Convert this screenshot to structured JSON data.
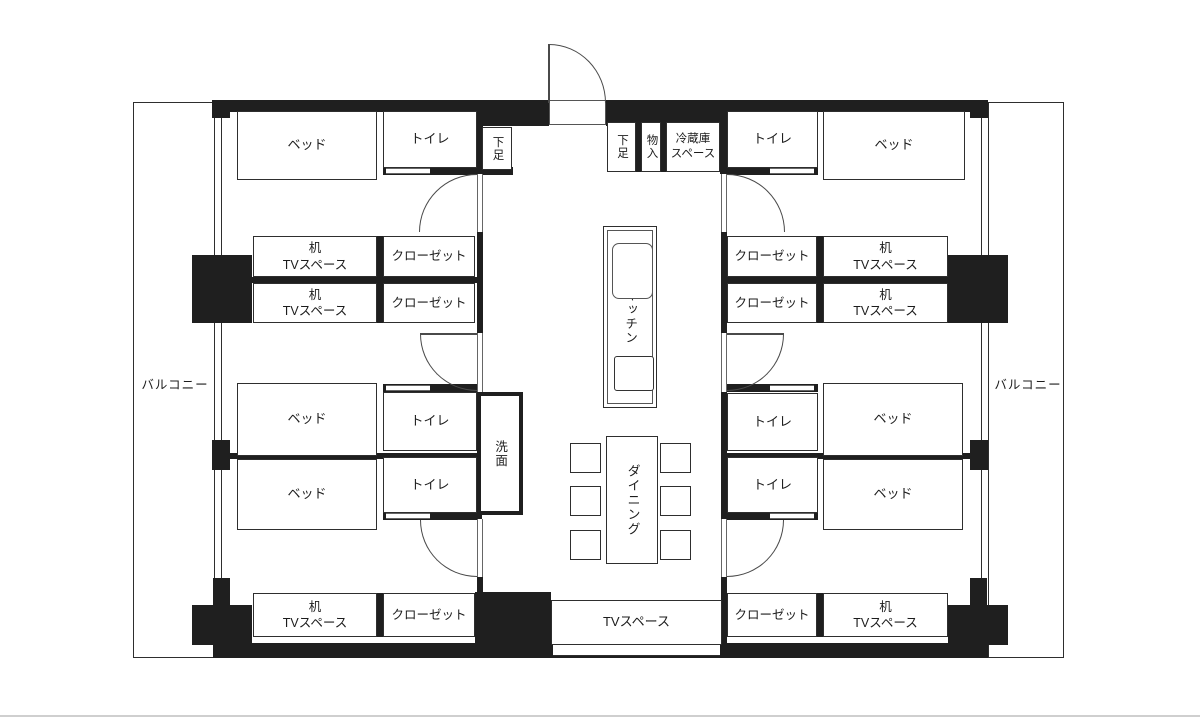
{
  "labels": {
    "balcony": "バルコニー",
    "bed": "ベッド",
    "toilet": "トイレ",
    "shoes": "下足",
    "storage": "物入",
    "fridge_line1": "冷蔵庫",
    "fridge_line2": "スペース",
    "desk_line1": "机",
    "desk_line2": "TVスペース",
    "closet": "クローゼット",
    "kitchen": "キッチン",
    "dining": "ダイニング",
    "washroom": "洗面",
    "tv_space": "TVスペース"
  },
  "colors": {
    "wall": "#1f1f1f",
    "line": "#2e2e2e",
    "background": "#ffffff"
  }
}
